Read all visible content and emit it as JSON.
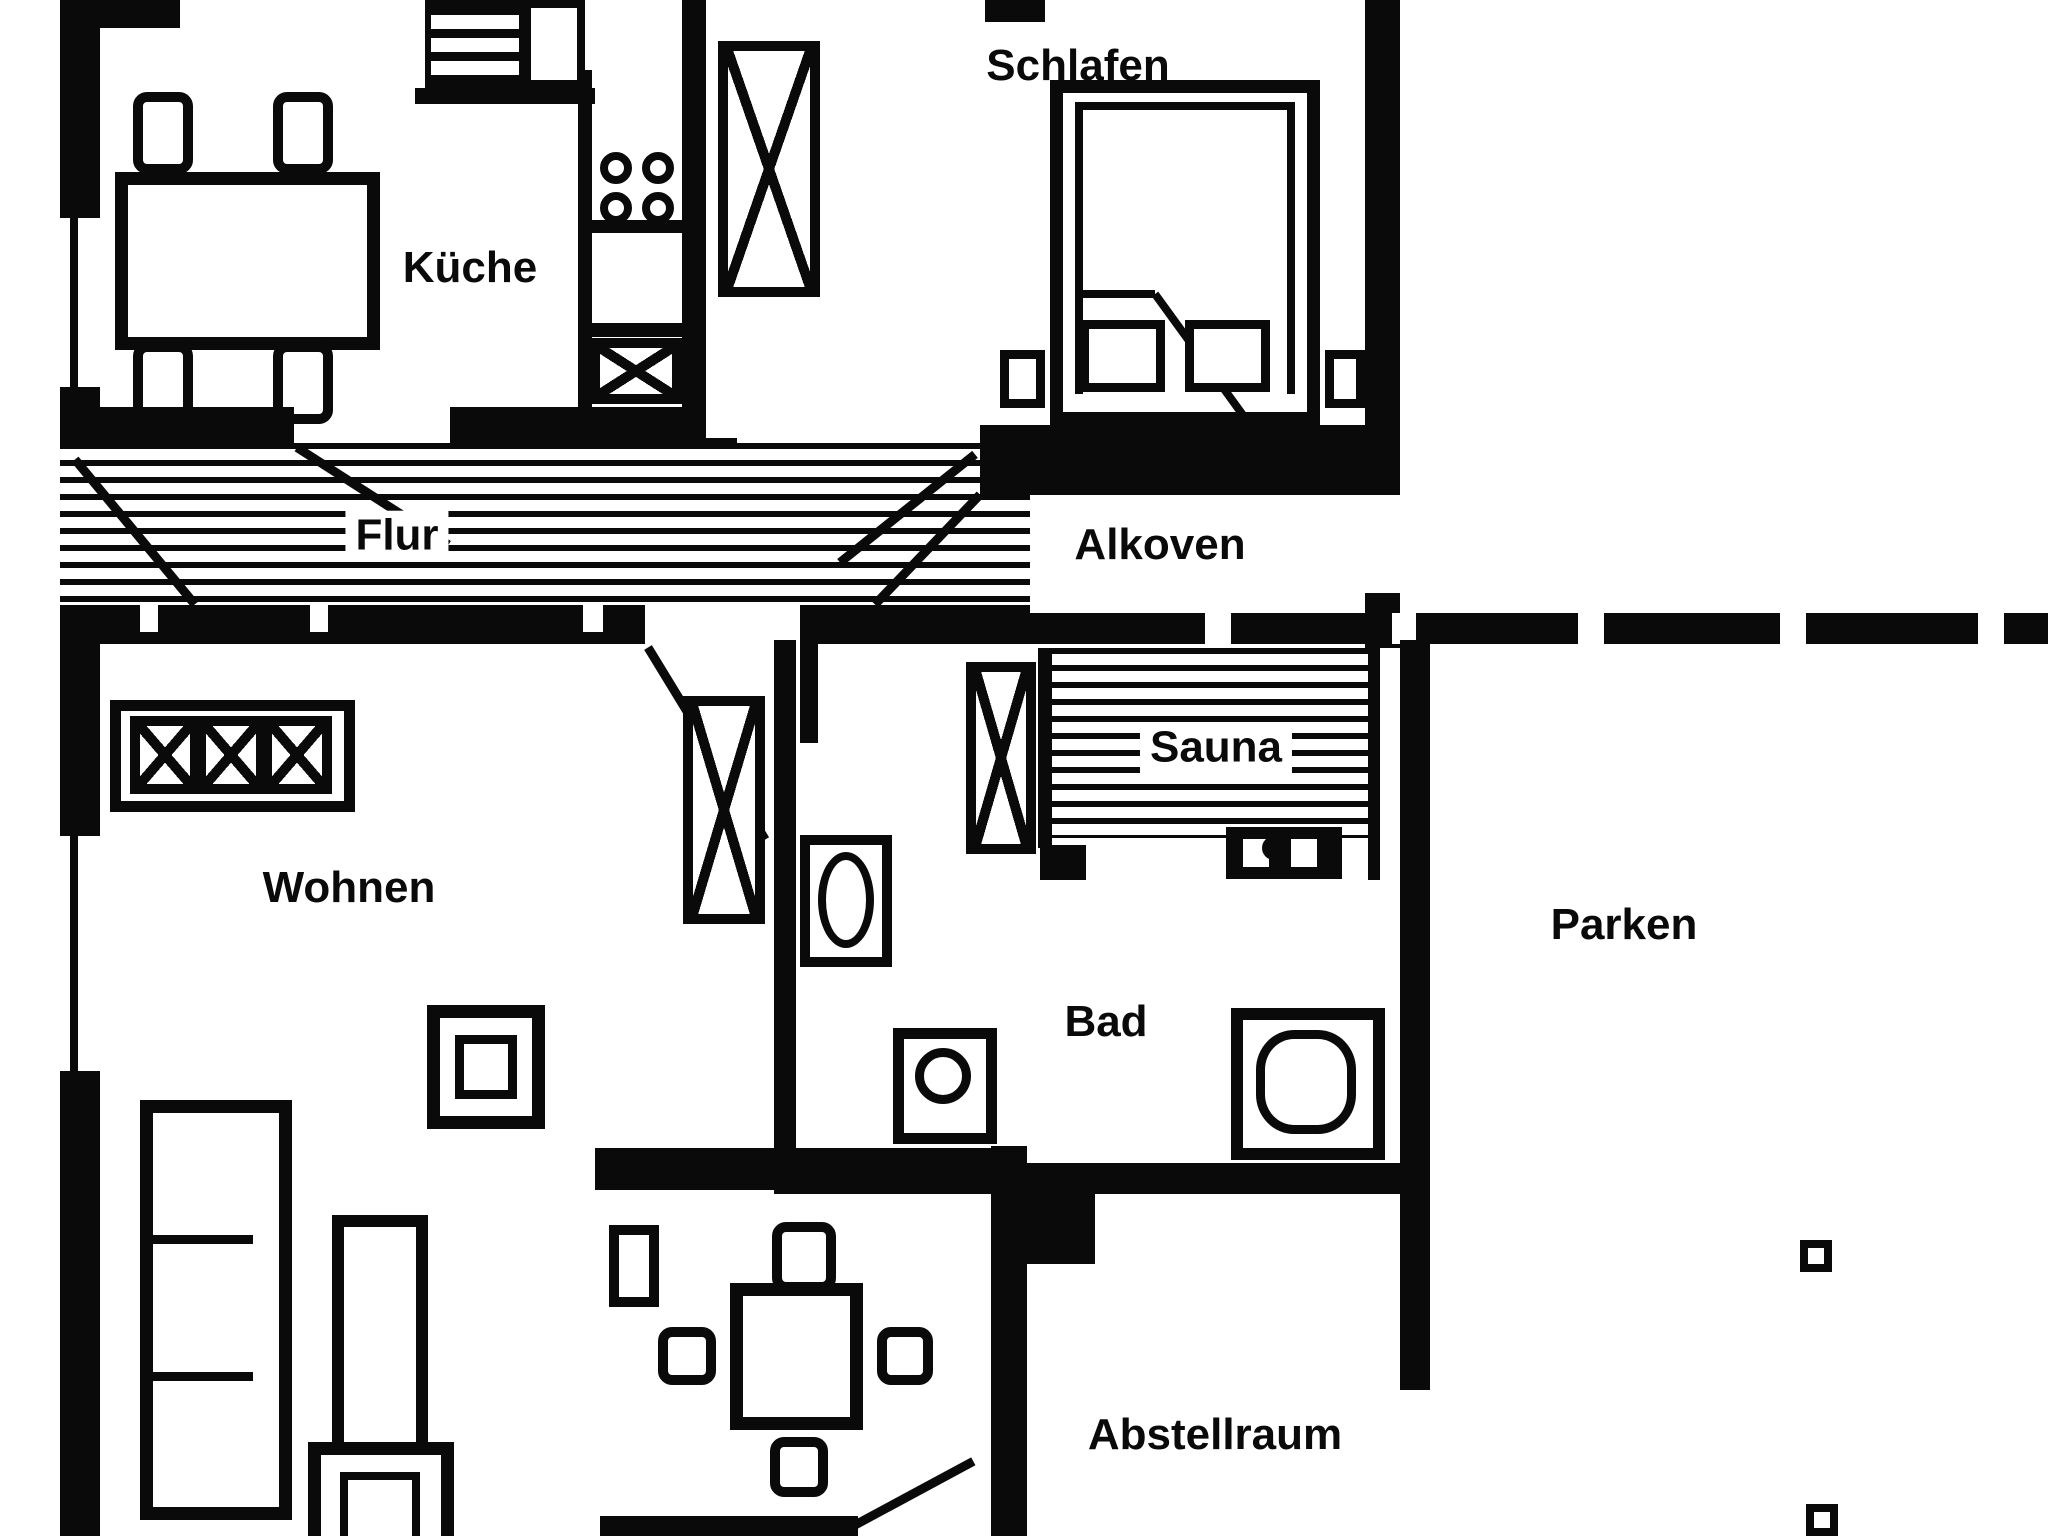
{
  "title": "apartment-floor-plan",
  "colors": {
    "ink": "#0a0a0a",
    "paper": "#ffffff"
  },
  "rooms": [
    {
      "id": "kueche",
      "label": "Küche",
      "furniture": [
        "dining-table",
        "chair",
        "chair",
        "chair",
        "chair",
        "oven",
        "stove-top",
        "sink",
        "counter"
      ]
    },
    {
      "id": "schlafen",
      "label": "Schlafen",
      "furniture": [
        "double-bed",
        "pillow",
        "pillow",
        "nightstand",
        "nightstand",
        "wardrobe"
      ]
    },
    {
      "id": "flur",
      "label": "Flur",
      "furniture": [
        "striped-floor",
        "door-swing",
        "door-swing"
      ]
    },
    {
      "id": "alkoven",
      "label": "Alkoven",
      "furniture": []
    },
    {
      "id": "wohnen",
      "label": "Wohnen",
      "furniture": [
        "closet-3",
        "tall-cabinet",
        "armchair",
        "couch",
        "coffee-table",
        "armchair",
        "stool",
        "dining-table",
        "chair",
        "chair",
        "chair",
        "chair"
      ]
    },
    {
      "id": "sauna",
      "label": "Sauna",
      "furniture": [
        "bench-stripes",
        "sauna-heater",
        "tall-cabinet"
      ]
    },
    {
      "id": "bad",
      "label": "Bad",
      "furniture": [
        "toilet",
        "washing-machine",
        "shower"
      ]
    },
    {
      "id": "parken",
      "label": "Parken",
      "furniture": [
        "fence-post",
        "fence-post"
      ]
    },
    {
      "id": "abstellraum",
      "label": "Abstellraum",
      "furniture": [
        "door-swing"
      ]
    }
  ],
  "fence": {
    "post_gaps": 5
  }
}
